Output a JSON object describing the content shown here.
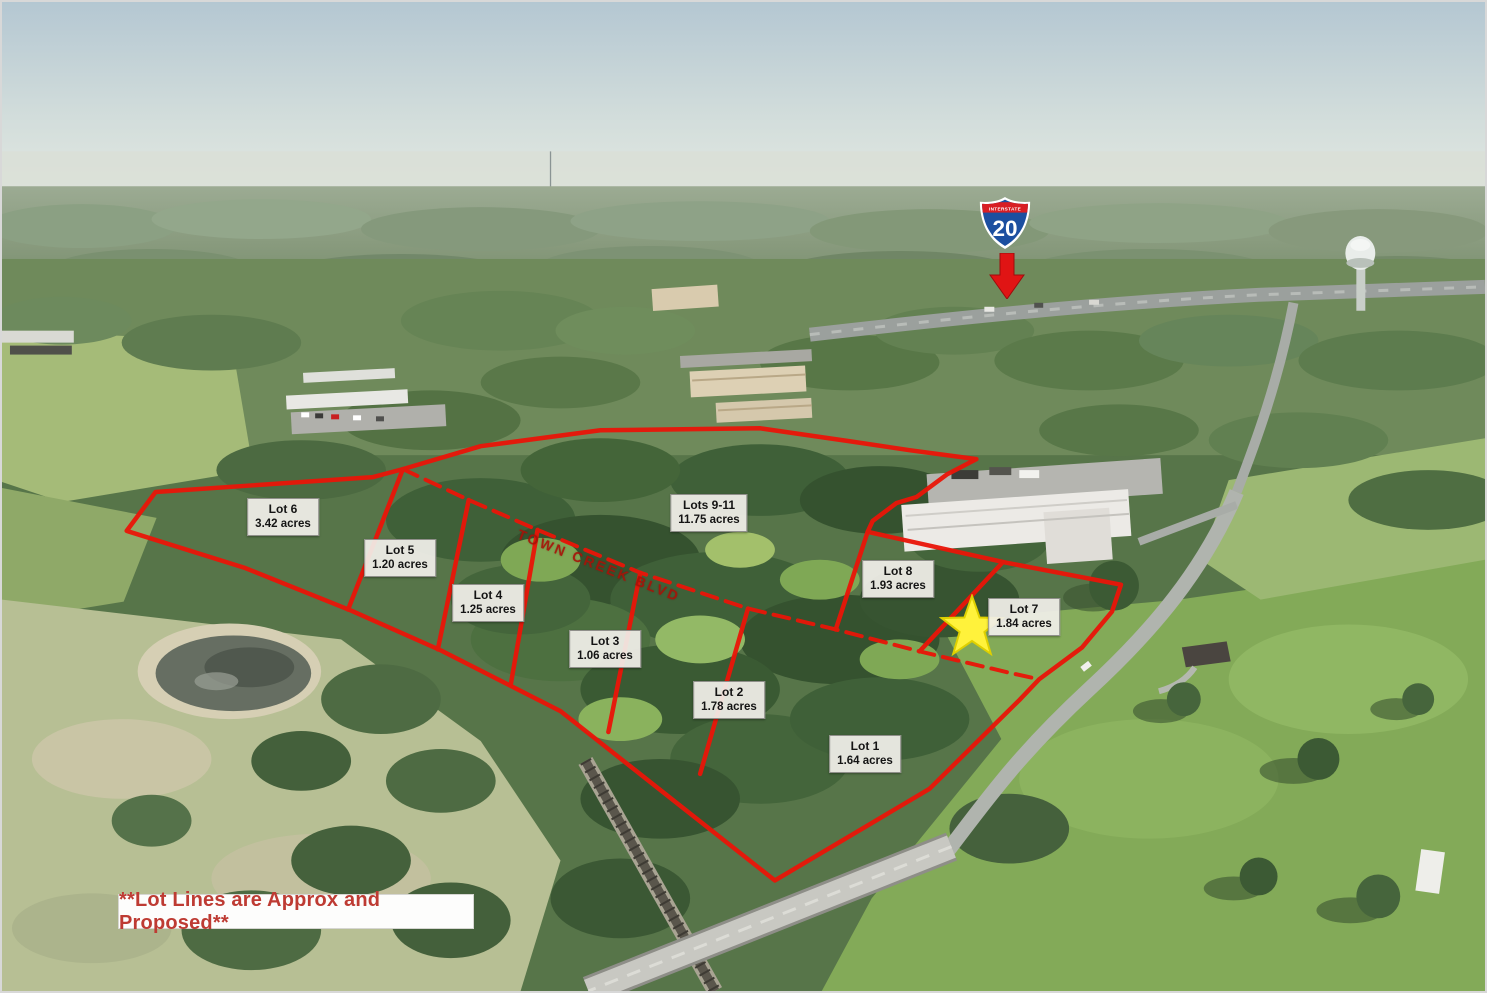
{
  "annotations": {
    "interstate_shield": {
      "top_label": "INTERSTATE",
      "number": "20"
    },
    "road_label": "TOWN CREEK BLVD",
    "disclaimer": "**Lot Lines are Approx and Proposed**",
    "lots": [
      {
        "name": "Lot 6",
        "acreage": "3.42 acres"
      },
      {
        "name": "Lot 5",
        "acreage": "1.20 acres"
      },
      {
        "name": "Lot 4",
        "acreage": "1.25 acres"
      },
      {
        "name": "Lot 3",
        "acreage": "1.06 acres"
      },
      {
        "name": "Lot 2",
        "acreage": "1.78 acres"
      },
      {
        "name": "Lot 1",
        "acreage": "1.64 acres"
      },
      {
        "name": "Lot 8",
        "acreage": "1.93 acres"
      },
      {
        "name": "Lot 7",
        "acreage": "1.84 acres"
      },
      {
        "name": "Lots 9-11",
        "acreage": "11.75 acres"
      }
    ],
    "colors": {
      "lot_line": "#EA1508",
      "label_bg": "#F1EFE9",
      "star_fill": "#FFF23B",
      "shield_blue": "#1C4FA0",
      "shield_band_red": "#D81E24",
      "arrow_red": "#E01414",
      "disclaimer_text": "#BE3B33",
      "road_label_text": "#A81208"
    }
  }
}
